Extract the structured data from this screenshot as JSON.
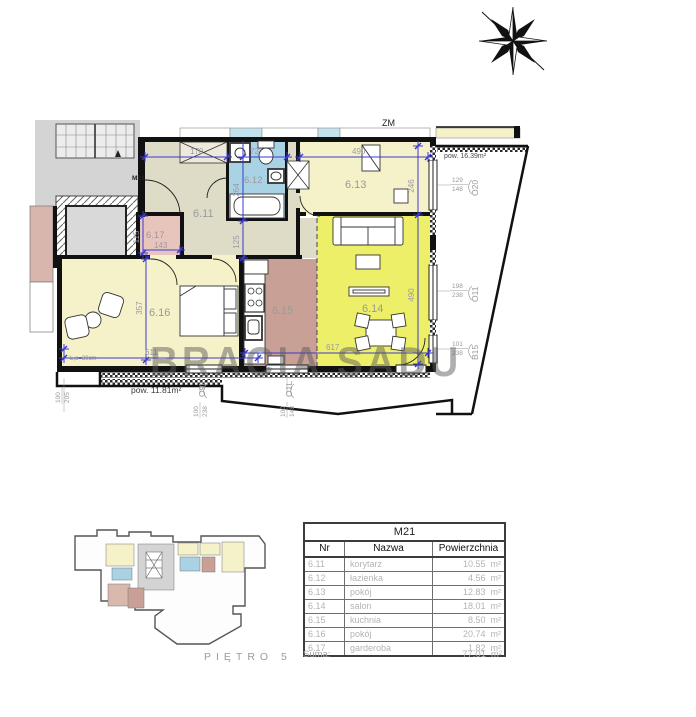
{
  "watermark": "BRACIA SADU",
  "plan": {
    "unit_label": "M21",
    "zm_label": "ZM",
    "rooms": {
      "r611": "6.11",
      "r612": "6.12",
      "r613": "6.13",
      "r614": "6.14",
      "r615": "6.15",
      "r616": "6.16",
      "r617": "6.17"
    },
    "dims": {
      "d170": "170",
      "d72": "72",
      "d490_top": "490",
      "d264": "264",
      "d125": "125",
      "d246": "246",
      "d490_right": "490",
      "d115": "115",
      "d143": "143",
      "d357": "357",
      "d611": "611",
      "d617": "617"
    },
    "left_dim": {
      "w": "100",
      "h": "205"
    },
    "notes": {
      "lintel": "L,o=30cm",
      "balcony_right_area": "pow. 16.39m²",
      "balcony_bottom_area": "pow. 11.81m²"
    },
    "windows_right": [
      {
        "w": "129",
        "h": "148",
        "code": "O20"
      },
      {
        "w": "198",
        "h": "238",
        "code": "O11"
      },
      {
        "w": "101",
        "h": "238",
        "code": "B15"
      }
    ],
    "windows_bottom": [
      {
        "w": "100",
        "h": "238",
        "code": "O9L"
      },
      {
        "w": "100",
        "h": "148",
        "code": "O1L"
      }
    ]
  },
  "mini_plan": {
    "floor_label": "PIĘTRO",
    "floor_number": "5"
  },
  "table": {
    "title": "M21",
    "columns": [
      "Nr",
      "Nazwa",
      "Powierzchnia"
    ],
    "rows": [
      {
        "nr": "6.11",
        "nazwa": "korytarz",
        "pow": "10.55",
        "unit": "m²"
      },
      {
        "nr": "6.12",
        "nazwa": "łazienka",
        "pow": "4.56",
        "unit": "m²"
      },
      {
        "nr": "6.13",
        "nazwa": "pokój",
        "pow": "12.83",
        "unit": "m²"
      },
      {
        "nr": "6.14",
        "nazwa": "salon",
        "pow": "18.01",
        "unit": "m²"
      },
      {
        "nr": "6.15",
        "nazwa": "kuchnia",
        "pow": "8.50",
        "unit": "m²"
      },
      {
        "nr": "6.16",
        "nazwa": "pokój",
        "pow": "20.74",
        "unit": "m²"
      },
      {
        "nr": "6.17",
        "nazwa": "garderoba",
        "pow": "1.82",
        "unit": "m²"
      }
    ],
    "suma_label": "Suma:",
    "suma_value": "77.01",
    "suma_unit": "m²"
  },
  "colors": {
    "room_yellow": "#f5f1c9",
    "salon_yellow": "#edef68",
    "kitchen_mauve": "#c9a096",
    "bath_blue": "#a9d2e4",
    "garderoba_pink": "#e7c5bd",
    "corridor_beige": "#dedbc7",
    "core_gray": "#d4d4d4",
    "dim_blue": "#3a3ad0",
    "dim_text_gray": "#9a9a9a"
  }
}
